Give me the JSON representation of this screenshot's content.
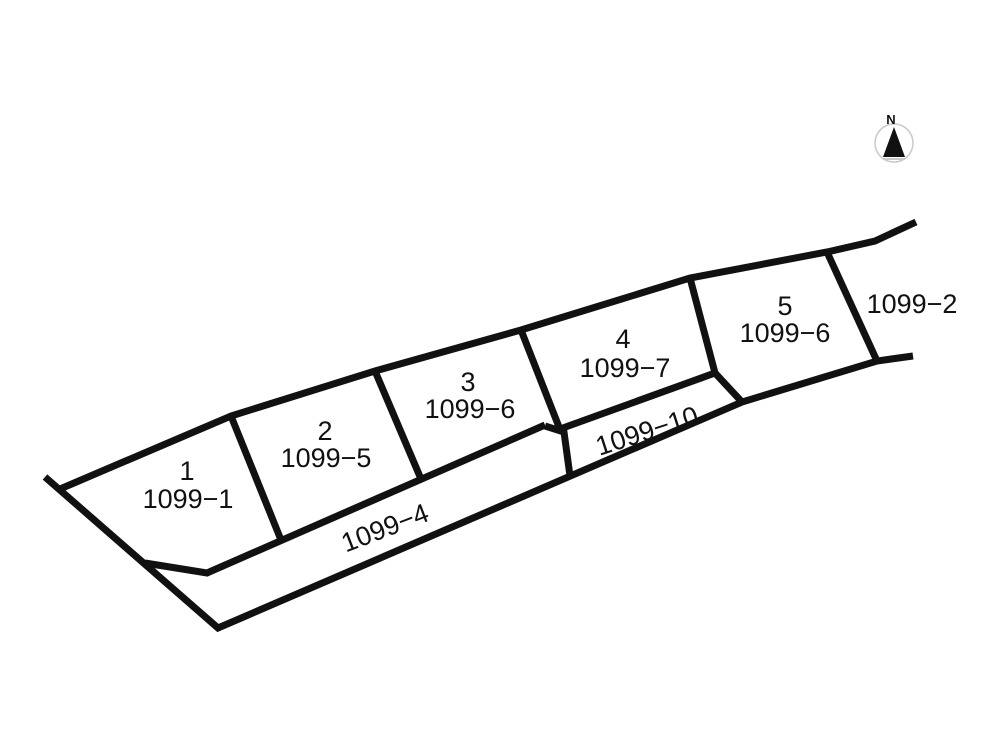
{
  "compass": {
    "label": "N"
  },
  "plots": [
    {
      "number": "1",
      "parcel": "1099−1"
    },
    {
      "number": "2",
      "parcel": "1099−5"
    },
    {
      "number": "3",
      "parcel": "1099−6"
    },
    {
      "number": "4",
      "parcel": "1099−7"
    },
    {
      "number": "5",
      "parcel": "1099−6"
    }
  ],
  "strips": [
    {
      "parcel": "1099−4"
    },
    {
      "parcel": "1099−10"
    }
  ],
  "adjacent": {
    "parcel": "1099−2"
  },
  "colors": {
    "line": "#111111",
    "text": "#111111",
    "background": "#ffffff",
    "compass_circle": "#c9c9c9",
    "compass_needle": "#111111"
  }
}
